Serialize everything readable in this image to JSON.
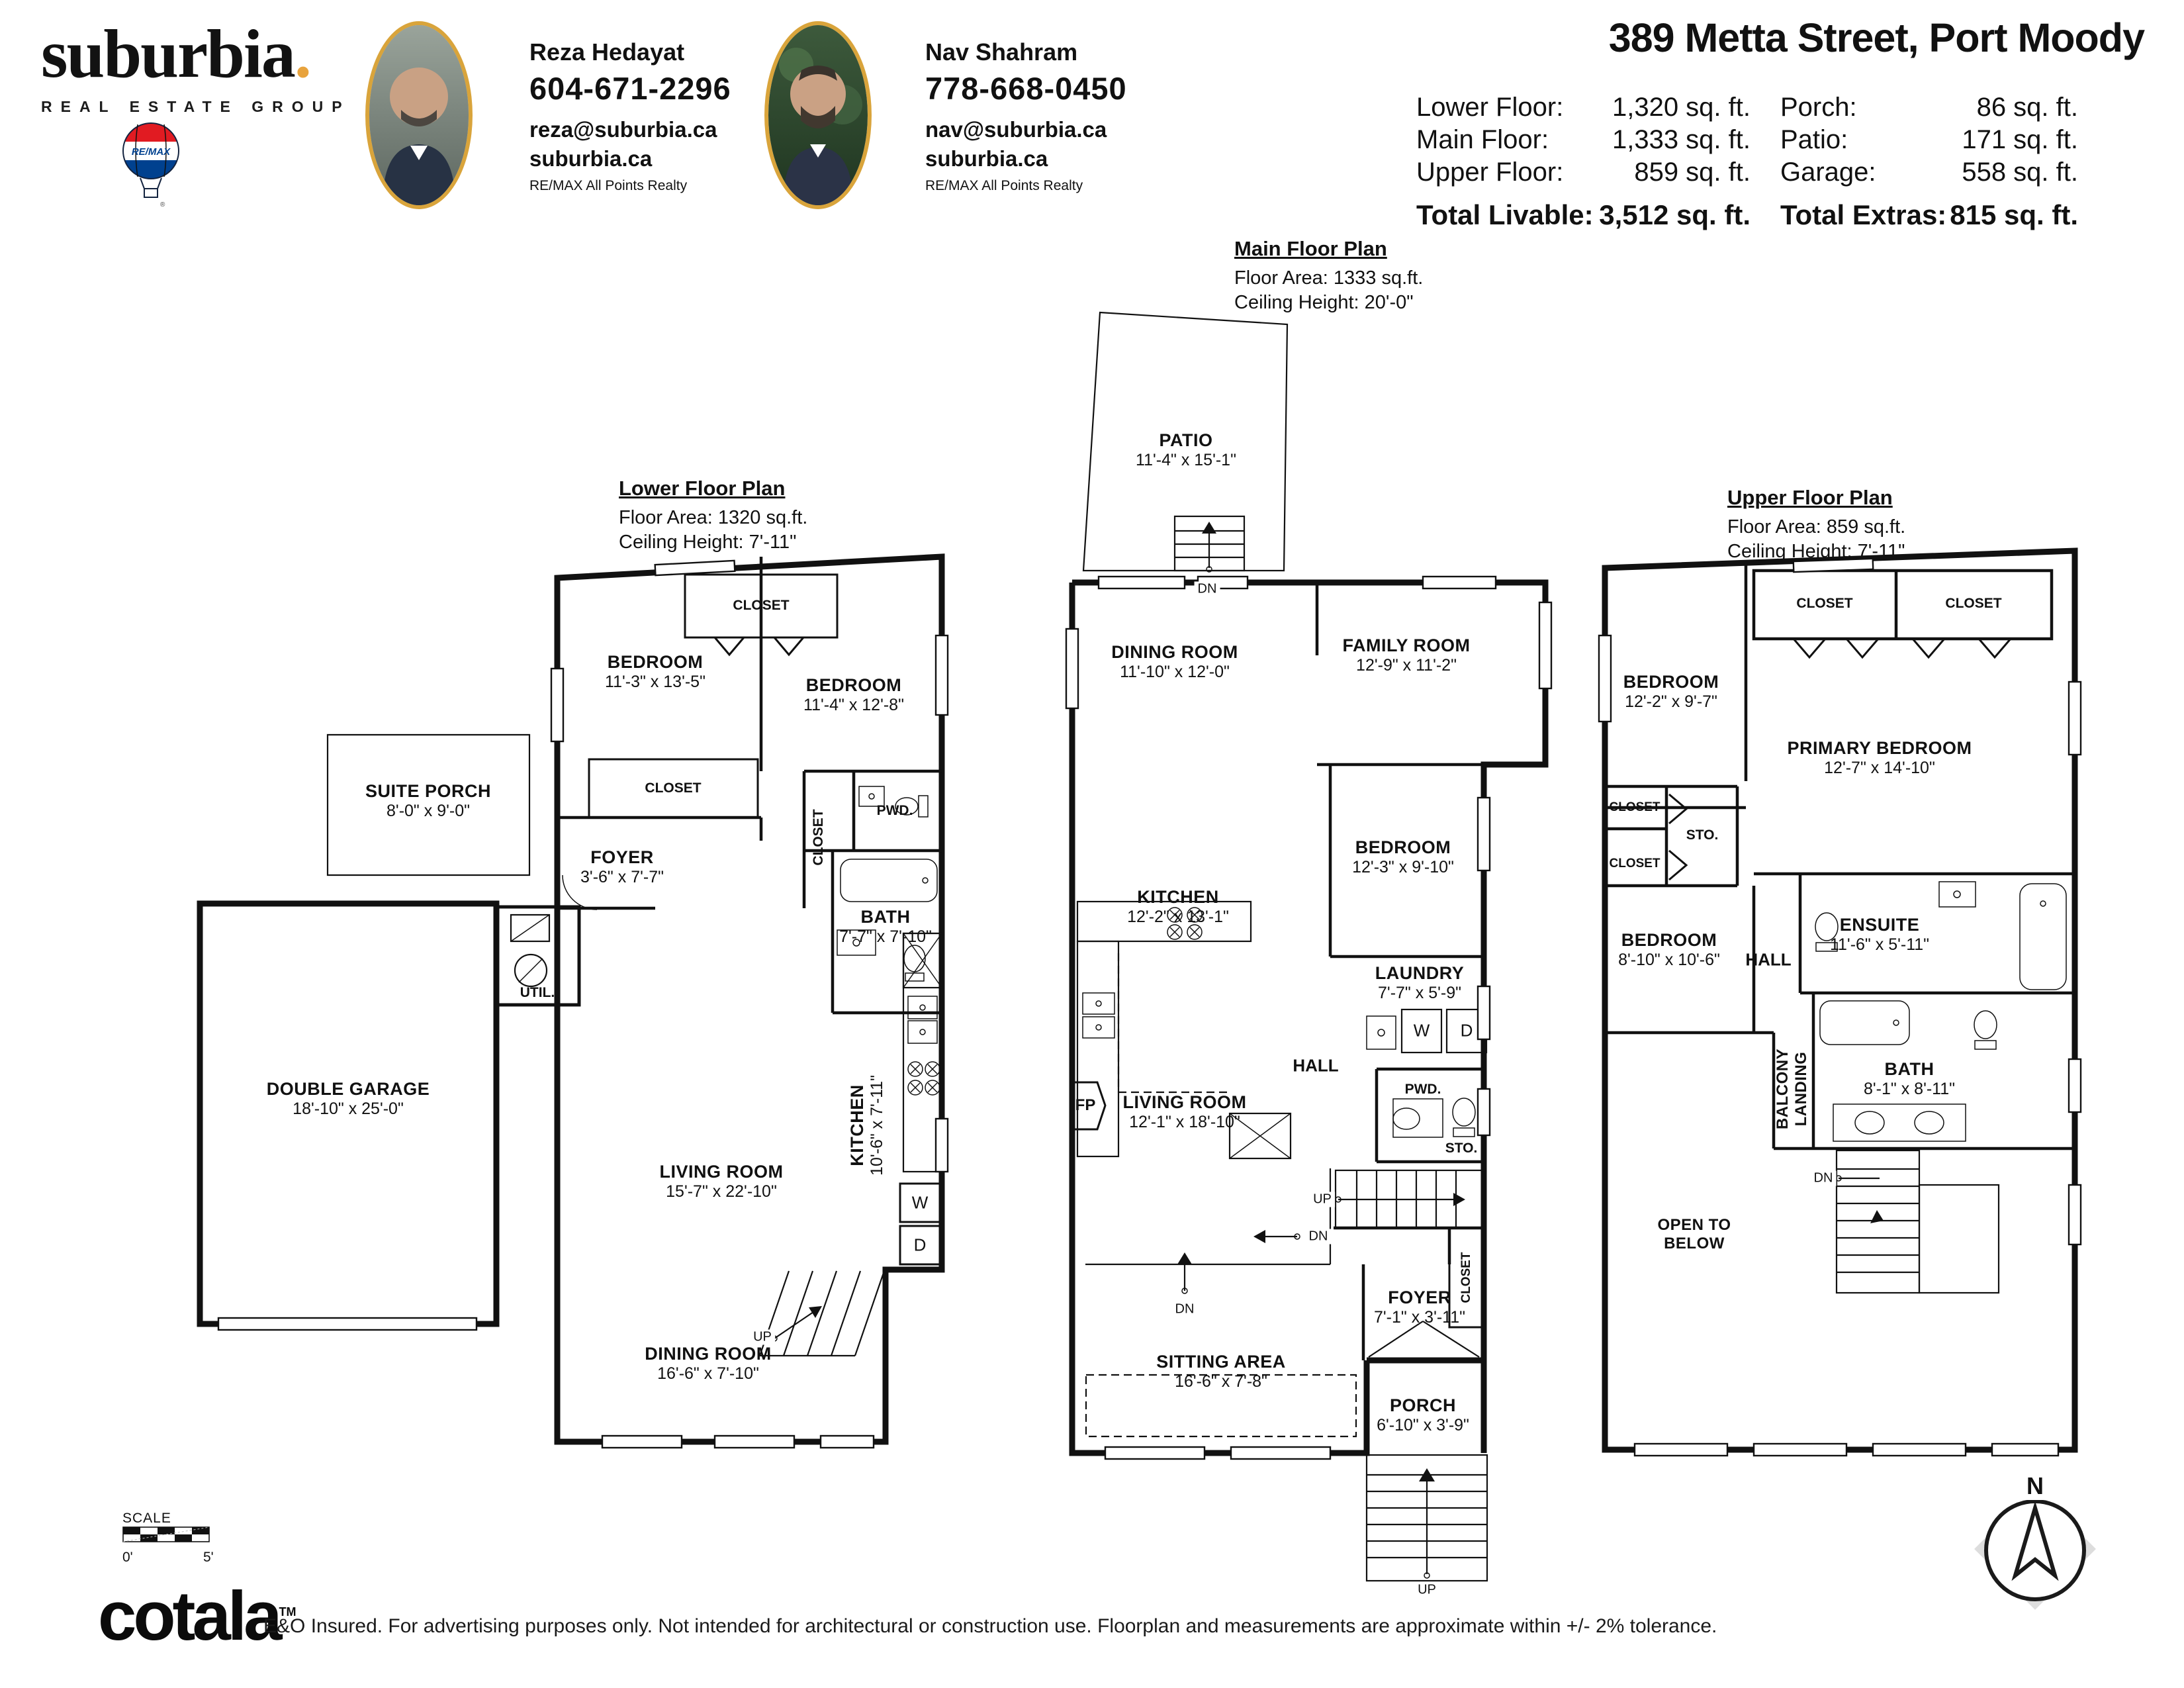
{
  "header": {
    "brand": {
      "logo": "suburbia",
      "logo_dot": ".",
      "tagline": "REAL ESTATE GROUP",
      "remax": "RE/MAX"
    },
    "agents": [
      {
        "name": "Reza Hedayat",
        "phone": "604-671-2296",
        "email": "reza@suburbia.ca",
        "website": "suburbia.ca",
        "brokerage": "RE/MAX All Points Realty"
      },
      {
        "name": "Nav Shahram",
        "phone": "778-668-0450",
        "email": "nav@suburbia.ca",
        "website": "suburbia.ca",
        "brokerage": "RE/MAX All Points Realty"
      }
    ],
    "title": "389 Metta Street, Port Moody",
    "stats": {
      "rows": [
        {
          "label": "Lower Floor:",
          "value": "1,320 sq. ft."
        },
        {
          "label": "Main Floor:",
          "value": "1,333 sq. ft."
        },
        {
          "label": "Upper Floor:",
          "value": "859 sq. ft."
        }
      ],
      "rows_right": [
        {
          "label": "Porch:",
          "value": "86 sq. ft."
        },
        {
          "label": "Patio:",
          "value": "171 sq. ft."
        },
        {
          "label": "Garage:",
          "value": "558 sq. ft."
        }
      ],
      "total_livable_label": "Total Livable:",
      "total_livable_value": "3,512 sq. ft.",
      "total_extras_label": "Total Extras:",
      "total_extras_value": "815 sq. ft."
    }
  },
  "plans": {
    "lower": {
      "heading": "Lower Floor Plan",
      "area": "Floor Area: 1320 sq.ft.",
      "ceiling": "Ceiling Height: 7'-11\"",
      "rooms": {
        "bedroom1": {
          "name": "BEDROOM",
          "dims": "11'-3\" x 13'-5\""
        },
        "bedroom2": {
          "name": "BEDROOM",
          "dims": "11'-4\" x 12'-8\""
        },
        "closet_top": {
          "label": "CLOSET"
        },
        "closet1": {
          "label": "CLOSET"
        },
        "suite_porch": {
          "name": "SUITE PORCH",
          "dims": "8'-0\" x 9'-0\""
        },
        "foyer": {
          "name": "FOYER",
          "dims": "3'-6\" x 7'-7\""
        },
        "closet_vert": {
          "label": "CLOSET"
        },
        "pwd": {
          "label": "PWD."
        },
        "bath": {
          "name": "BATH",
          "dims": "7'-7\" x 7'-10\""
        },
        "util": {
          "label": "UTIL."
        },
        "garage": {
          "name": "DOUBLE GARAGE",
          "dims": "18'-10\" x 25'-0\""
        },
        "living": {
          "name": "LIVING ROOM",
          "dims": "15'-7\" x 22'-10\""
        },
        "kitchen": {
          "name": "KITCHEN",
          "dims": "10'-6\" x 7'-11\""
        },
        "washer": {
          "label": "W"
        },
        "dryer": {
          "label": "D"
        },
        "stairs_up": {
          "label": "UP"
        },
        "dining": {
          "name": "DINING ROOM",
          "dims": "16'-6\" x 7'-10\""
        }
      }
    },
    "main": {
      "heading": "Main Floor Plan",
      "area": "Floor Area: 1333 sq.ft.",
      "ceiling": "Ceiling Height: 20'-0\"",
      "rooms": {
        "patio": {
          "name": "PATIO",
          "dims": "11'-4\" x 15'-1\""
        },
        "patio_dn": {
          "label": "DN"
        },
        "dining": {
          "name": "DINING ROOM",
          "dims": "11'-10\" x 12'-0\""
        },
        "family": {
          "name": "FAMILY ROOM",
          "dims": "12'-9\" x 11'-2\""
        },
        "kitchen": {
          "name": "KITCHEN",
          "dims": "12'-2\" x 13'-1\""
        },
        "bedroom": {
          "name": "BEDROOM",
          "dims": "12'-3\" x 9'-10\""
        },
        "laundry": {
          "name": "LAUNDRY",
          "dims": "7'-7\" x 5'-9\""
        },
        "washer": {
          "label": "W"
        },
        "dryer": {
          "label": "D"
        },
        "hall": {
          "label": "HALL"
        },
        "pwd": {
          "label": "PWD."
        },
        "fp": {
          "label": "FP"
        },
        "living": {
          "name": "LIVING ROOM",
          "dims": "12'-1\" x 18'-10\""
        },
        "sto": {
          "label": "STO."
        },
        "stairs_up": {
          "label": "UP"
        },
        "dn1": {
          "label": "DN"
        },
        "dn2": {
          "label": "DN"
        },
        "closet_vert": {
          "label": "CLOSET"
        },
        "foyer": {
          "name": "FOYER",
          "dims": "7'-1\" x 3'-11\""
        },
        "sitting": {
          "name": "SITTING AREA",
          "dims": "16'-6\" x 7'-8\""
        },
        "porch": {
          "name": "PORCH",
          "dims": "6'-10\" x 3'-9\""
        },
        "porch_up": {
          "label": "UP"
        }
      }
    },
    "upper": {
      "heading": "Upper Floor Plan",
      "area": "Floor Area: 859 sq.ft.",
      "ceiling": "Ceiling Height: 7'-11\"",
      "rooms": {
        "bedroom1": {
          "name": "BEDROOM",
          "dims": "12'-2\" x 9'-7\""
        },
        "closet1": {
          "label": "CLOSET"
        },
        "closet2": {
          "label": "CLOSET"
        },
        "primary": {
          "name": "PRIMARY BEDROOM",
          "dims": "12'-7\" x 14'-10\""
        },
        "closet3": {
          "label": "CLOSET"
        },
        "sto": {
          "label": "STO."
        },
        "closet4": {
          "label": "CLOSET"
        },
        "bedroom2": {
          "name": "BEDROOM",
          "dims": "8'-10\" x 10'-6\""
        },
        "hall": {
          "label": "HALL"
        },
        "ensuite": {
          "name": "ENSUITE",
          "dims": "11'-6\" x 5'-11\""
        },
        "balcony_line1": {
          "label": "BALCONY"
        },
        "balcony_line2": {
          "label": "LANDING"
        },
        "bath": {
          "name": "BATH",
          "dims": "8'-1\" x 8'-11\""
        },
        "dn": {
          "label": "DN"
        },
        "open_below_line1": {
          "label": "OPEN TO"
        },
        "open_below_line2": {
          "label": "BELOW"
        }
      }
    }
  },
  "footer": {
    "scale_label": "SCALE",
    "scale_start": "0'",
    "scale_end": "5'",
    "logo": "cotala",
    "logo_tm": "TM",
    "disclaimer": "E&O Insured. For advertising purposes only. Not intended for architectural or construction use. Floorplan and measurements are approximate within +/- 2% tolerance."
  },
  "compass": {
    "n": "N"
  }
}
